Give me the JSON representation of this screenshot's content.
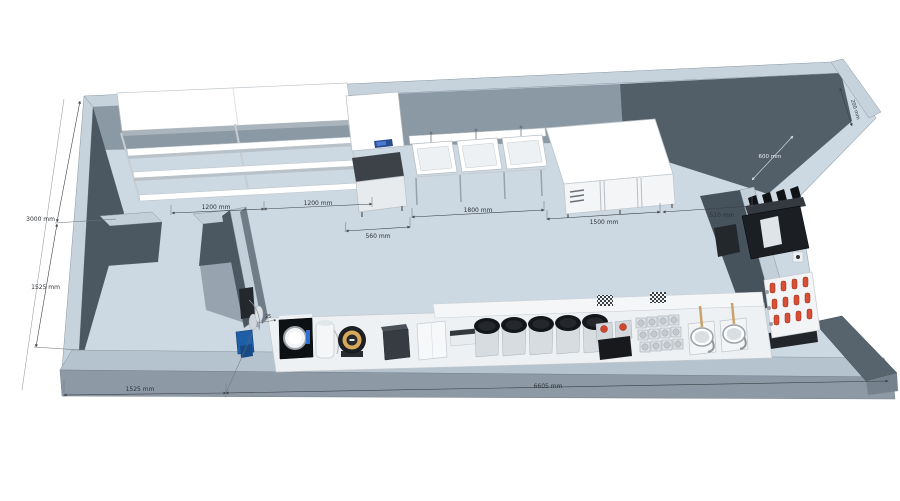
{
  "title": "kitchen-3d-plan",
  "dimensions": {
    "shelf_bay_1": "1200 mm",
    "shelf_bay_2": "1200 mm",
    "ice_machine_width": "560 mm",
    "sink_unit_width": "1800 mm",
    "fridge_counter_width": "1500 mm",
    "right_gap_width": "510 mm",
    "back_depth": "3000 mm",
    "side_room_depth": "1525 mm",
    "front_left_width": "1525 mm",
    "front_total_width": "6605 mm",
    "right_wall_length": "600 mm",
    "right_wall_return": "200 mm",
    "counter_offset": "25"
  },
  "equipment_icons": [
    "wall-shelving-icon",
    "ice-machine-icon",
    "triple-sink-icon",
    "fridge-counter-icon",
    "espresso-machine-icon",
    "tap-tower-icon",
    "water-filter-icon",
    "pearl-cooker-icon",
    "water-purifier-icon",
    "sealing-machine-icon",
    "blender-icon",
    "tea-urn-icon",
    "canister-grid-icon",
    "wash-sink-icon"
  ],
  "colors": {
    "floor": "#ccd8e2",
    "wall_top": "#c6d3dd",
    "wall_dark": "#4b5761",
    "wall_medium": "#8b99a5",
    "parapet_front": "#8d9aa6",
    "accent_blue": "#1f5fa8",
    "accent_red": "#d0452e",
    "tap_red": "#d94f35",
    "ring_tan": "#d9a95b"
  }
}
